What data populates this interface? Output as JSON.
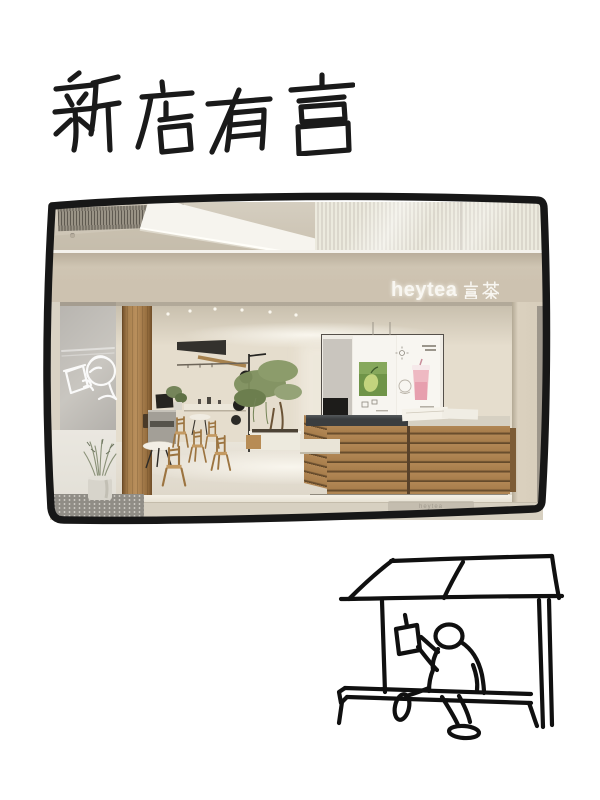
{
  "title": {
    "text": "新店有喜"
  },
  "photo": {
    "storefront_sign": {
      "latin": "heytea",
      "cjk": "喜茶"
    },
    "doormat_label": "heytea",
    "neon_sign_icon": "person-drinking-neon-logo",
    "menu_board_panels": [
      "merch-display",
      "fruit-poster",
      "pink-drink-poster"
    ]
  },
  "sketch": {
    "icon": "person-drinking-under-tea-stall"
  },
  "colors": {
    "ink": "#1a1a1a",
    "paper": "#ffffff",
    "fascia_beige": "#cdc2b0",
    "wood_counter": "#a87e4c",
    "wood_pillar": "#a9814f",
    "sign_white": "#f8f6f1",
    "foliage_green": "#7e8f5e",
    "drink_pink": "#e79fae"
  }
}
